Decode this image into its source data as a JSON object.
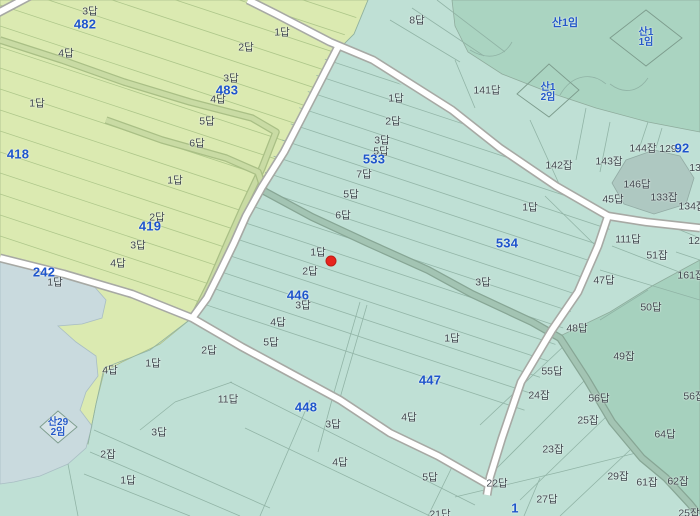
{
  "map": {
    "type": "cadastral-parcel-map",
    "colors": {
      "paddy_teal": "#bfe0d5",
      "field_green": "#dbeab1",
      "forest_green": "#aad4c1",
      "water_grey": "#c9dade",
      "canal_teal": "#a3c4b3",
      "canal_green": "#c9dba4",
      "road_fill": "#ffffff",
      "road_casing": "#a7a9a4",
      "label_grey": "#3e464c",
      "label_blue": "#1e55cb",
      "marker_red": "#e7241d"
    },
    "marker": {
      "x": 331,
      "y": 261,
      "color": "#e7241d"
    },
    "labels": [
      {
        "t": "3답",
        "x": 90,
        "y": 11,
        "c": "lot"
      },
      {
        "t": "482",
        "x": 85,
        "y": 24,
        "c": "num"
      },
      {
        "t": "4답",
        "x": 66,
        "y": 53,
        "c": "lot"
      },
      {
        "t": "1답",
        "x": 37,
        "y": 103,
        "c": "lot"
      },
      {
        "t": "2답",
        "x": 246,
        "y": 47,
        "c": "lot"
      },
      {
        "t": "3답",
        "x": 231,
        "y": 78,
        "c": "lot"
      },
      {
        "t": "483",
        "x": 227,
        "y": 90,
        "c": "num"
      },
      {
        "t": "4답",
        "x": 218,
        "y": 99,
        "c": "lot"
      },
      {
        "t": "5답",
        "x": 207,
        "y": 121,
        "c": "lot"
      },
      {
        "t": "6답",
        "x": 197,
        "y": 143,
        "c": "lot"
      },
      {
        "t": "418",
        "x": 18,
        "y": 154,
        "c": "num"
      },
      {
        "t": "1답",
        "x": 175,
        "y": 180,
        "c": "lot"
      },
      {
        "t": "2답",
        "x": 157,
        "y": 217,
        "c": "lot"
      },
      {
        "t": "419",
        "x": 150,
        "y": 226,
        "c": "num"
      },
      {
        "t": "3답",
        "x": 138,
        "y": 245,
        "c": "lot"
      },
      {
        "t": "4답",
        "x": 118,
        "y": 263,
        "c": "lot"
      },
      {
        "t": "242",
        "x": 44,
        "y": 272,
        "c": "num"
      },
      {
        "t": "1답",
        "x": 55,
        "y": 282,
        "c": "lot"
      },
      {
        "t": "1답",
        "x": 282,
        "y": 32,
        "c": "lot"
      },
      {
        "t": "8답",
        "x": 417,
        "y": 20,
        "c": "lot"
      },
      {
        "t": "141답",
        "x": 487,
        "y": 90,
        "c": "lot"
      },
      {
        "t": "1답",
        "x": 396,
        "y": 98,
        "c": "lot"
      },
      {
        "t": "2답",
        "x": 393,
        "y": 121,
        "c": "lot"
      },
      {
        "t": "3답",
        "x": 382,
        "y": 140,
        "c": "lot"
      },
      {
        "t": "5답",
        "x": 381,
        "y": 151,
        "c": "lot"
      },
      {
        "t": "533",
        "x": 374,
        "y": 159,
        "c": "num"
      },
      {
        "t": "7답",
        "x": 364,
        "y": 174,
        "c": "lot"
      },
      {
        "t": "5답",
        "x": 351,
        "y": 194,
        "c": "lot"
      },
      {
        "t": "6답",
        "x": 343,
        "y": 215,
        "c": "lot"
      },
      {
        "t": "1답",
        "x": 318,
        "y": 252,
        "c": "lot"
      },
      {
        "t": "2답",
        "x": 310,
        "y": 271,
        "c": "lot"
      },
      {
        "t": "446",
        "x": 298,
        "y": 295,
        "c": "num"
      },
      {
        "t": "3답",
        "x": 303,
        "y": 305,
        "c": "lot"
      },
      {
        "t": "4답",
        "x": 278,
        "y": 322,
        "c": "lot"
      },
      {
        "t": "5답",
        "x": 271,
        "y": 342,
        "c": "lot"
      },
      {
        "t": "1답",
        "x": 530,
        "y": 207,
        "c": "lot"
      },
      {
        "t": "534",
        "x": 507,
        "y": 243,
        "c": "num"
      },
      {
        "t": "3답",
        "x": 483,
        "y": 282,
        "c": "lot"
      },
      {
        "t": "1답",
        "x": 452,
        "y": 338,
        "c": "lot"
      },
      {
        "t": "2답",
        "x": 209,
        "y": 350,
        "c": "lot"
      },
      {
        "t": "1답",
        "x": 153,
        "y": 363,
        "c": "lot"
      },
      {
        "t": "4답",
        "x": 110,
        "y": 370,
        "c": "lot"
      },
      {
        "t": "142잡",
        "x": 559,
        "y": 165,
        "c": "lot"
      },
      {
        "t": "143잡",
        "x": 609,
        "y": 161,
        "c": "lot"
      },
      {
        "t": "144잡",
        "x": 643,
        "y": 148,
        "c": "lot"
      },
      {
        "t": "129",
        "x": 668,
        "y": 149,
        "c": "lot"
      },
      {
        "t": "92",
        "x": 682,
        "y": 148,
        "c": "num"
      },
      {
        "t": "130",
        "x": 698,
        "y": 168,
        "c": "lot"
      },
      {
        "t": "146답",
        "x": 637,
        "y": 184,
        "c": "lot"
      },
      {
        "t": "45답",
        "x": 613,
        "y": 199,
        "c": "lot"
      },
      {
        "t": "133잡",
        "x": 664,
        "y": 197,
        "c": "lot"
      },
      {
        "t": "134잡",
        "x": 692,
        "y": 206,
        "c": "lot"
      },
      {
        "t": "111답",
        "x": 628,
        "y": 239,
        "c": "lot"
      },
      {
        "t": "120",
        "x": 697,
        "y": 241,
        "c": "lot"
      },
      {
        "t": "51잡",
        "x": 657,
        "y": 255,
        "c": "lot"
      },
      {
        "t": "161잡",
        "x": 691,
        "y": 275,
        "c": "lot"
      },
      {
        "t": "47답",
        "x": 604,
        "y": 280,
        "c": "lot"
      },
      {
        "t": "50답",
        "x": 651,
        "y": 307,
        "c": "lot"
      },
      {
        "t": "48답",
        "x": 577,
        "y": 328,
        "c": "lot"
      },
      {
        "t": "산1임",
        "x": 565,
        "y": 22,
        "c": "san1"
      },
      {
        "t": "산1",
        "x": 646,
        "y": 33,
        "c": "san"
      },
      {
        "t": "1임",
        "x": 646,
        "y": 43,
        "c": "san"
      },
      {
        "t": "산1",
        "x": 548,
        "y": 88,
        "c": "san"
      },
      {
        "t": "2임",
        "x": 548,
        "y": 98,
        "c": "san"
      },
      {
        "t": "447",
        "x": 430,
        "y": 380,
        "c": "num"
      },
      {
        "t": "448",
        "x": 306,
        "y": 407,
        "c": "num"
      },
      {
        "t": "3답",
        "x": 333,
        "y": 424,
        "c": "lot"
      },
      {
        "t": "4답",
        "x": 409,
        "y": 417,
        "c": "lot"
      },
      {
        "t": "4답",
        "x": 340,
        "y": 462,
        "c": "lot"
      },
      {
        "t": "5답",
        "x": 430,
        "y": 477,
        "c": "lot"
      },
      {
        "t": "21답",
        "x": 440,
        "y": 514,
        "c": "lot"
      },
      {
        "t": "22답",
        "x": 497,
        "y": 483,
        "c": "lot"
      },
      {
        "t": "27답",
        "x": 547,
        "y": 499,
        "c": "lot"
      },
      {
        "t": "1",
        "x": 515,
        "y": 508,
        "c": "num"
      },
      {
        "t": "11답",
        "x": 228,
        "y": 399,
        "c": "lot"
      },
      {
        "t": "3답",
        "x": 159,
        "y": 432,
        "c": "lot"
      },
      {
        "t": "2잡",
        "x": 108,
        "y": 454,
        "c": "lot"
      },
      {
        "t": "1답",
        "x": 128,
        "y": 480,
        "c": "lot"
      },
      {
        "t": "산29",
        "x": 58,
        "y": 423,
        "c": "san"
      },
      {
        "t": "2임",
        "x": 58,
        "y": 433,
        "c": "san"
      },
      {
        "t": "49잡",
        "x": 624,
        "y": 356,
        "c": "lot"
      },
      {
        "t": "55답",
        "x": 552,
        "y": 371,
        "c": "lot"
      },
      {
        "t": "24잡",
        "x": 539,
        "y": 395,
        "c": "lot"
      },
      {
        "t": "56답",
        "x": 599,
        "y": 398,
        "c": "lot"
      },
      {
        "t": "56잡",
        "x": 694,
        "y": 396,
        "c": "lot"
      },
      {
        "t": "25잡",
        "x": 588,
        "y": 420,
        "c": "lot"
      },
      {
        "t": "64답",
        "x": 665,
        "y": 434,
        "c": "lot"
      },
      {
        "t": "23잡",
        "x": 553,
        "y": 449,
        "c": "lot"
      },
      {
        "t": "29잡",
        "x": 618,
        "y": 476,
        "c": "lot"
      },
      {
        "t": "61잡",
        "x": 647,
        "y": 482,
        "c": "lot"
      },
      {
        "t": "62잡",
        "x": 678,
        "y": 481,
        "c": "lot"
      },
      {
        "t": "25잡",
        "x": 689,
        "y": 513,
        "c": "lot"
      }
    ]
  }
}
